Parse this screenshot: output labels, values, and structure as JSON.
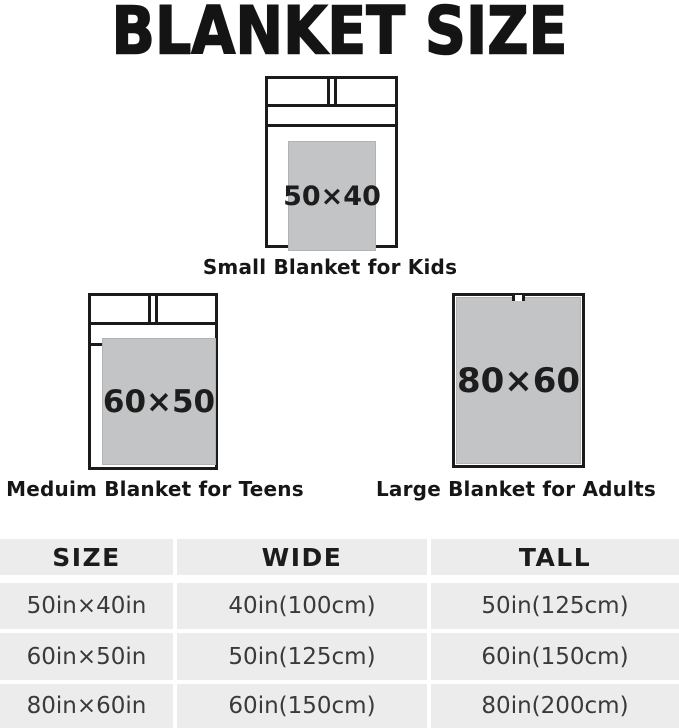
{
  "title": "BLANKET SIZE",
  "beds": [
    {
      "size_label": "50×40",
      "caption": "Small Blanket for Kids"
    },
    {
      "size_label": "60×50",
      "caption": "Meduim Blanket for Teens"
    },
    {
      "size_label": "80×60",
      "caption": "Large Blanket for Adults"
    }
  ],
  "table": {
    "headers": [
      "SIZE",
      "WIDE",
      "TALL"
    ],
    "rows": [
      [
        "50in×40in",
        "40in(100cm)",
        "50in(125cm)"
      ],
      [
        "60in×50in",
        "50in(125cm)",
        "60in(150cm)"
      ],
      [
        "80in×60in",
        "60in(150cm)",
        "80in(200cm)"
      ]
    ]
  },
  "colors": {
    "text": "#1a1a1a",
    "bed_border": "#1b1b1b",
    "blanket_fill": "#c2c4c5",
    "table_cell_bg": "#ececec",
    "table_text": "#3a3a3a"
  }
}
